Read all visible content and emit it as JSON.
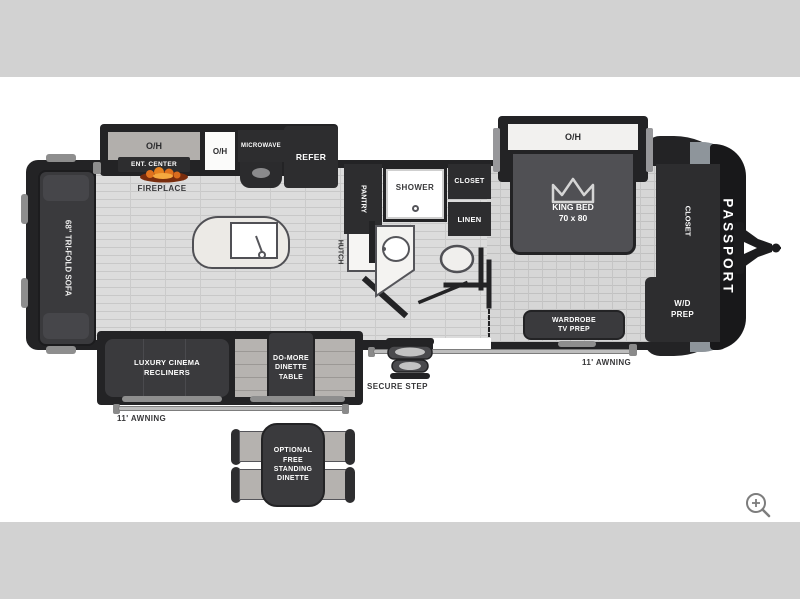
{
  "plan": {
    "kitchen": {
      "overhead_left": "O/H",
      "ent_center": "ENT. CENTER",
      "fireplace": "FIREPLACE",
      "overhead_mid": "O/H",
      "microwave": "MICROWAVE",
      "refrigerator": "REFER"
    },
    "living": {
      "sofa": "68\" TRI-FOLD SOFA",
      "pantry": "PANTRY",
      "hutch": "HUTCH",
      "recliners": "LUXURY CINEMA\nRECLINERS",
      "dinette_table": "DO-MORE\nDINETTE\nTABLE",
      "secure_step": "SECURE STEP",
      "awning": "11' AWNING"
    },
    "bathroom": {
      "shower": "SHOWER",
      "closet": "CLOSET",
      "linen": "LINEN"
    },
    "bedroom": {
      "overhead": "O/H",
      "king_bed": "KING BED\n70 x 80",
      "wardrobe": "WARDROBE\nTV PREP",
      "closet": "CLOSET",
      "wd_prep": "W/D\nPREP",
      "awning": "11' AWNING"
    },
    "exterior": {
      "brand": "PASSPORT"
    },
    "options": {
      "free_dinette": "OPTIONAL\nFREE\nSTANDING\nDINETTE"
    }
  },
  "viewer": {
    "zoom_button": "zoom-in"
  },
  "colors": {
    "letterbox_gray": "#d2d2d2",
    "wall_black": "#232325",
    "cabinet_dark": "#2d2d2f",
    "furniture_dark": "#3a3a3d",
    "bed_gray": "#505054",
    "floor_light": "#dcdcdc",
    "bench_gray": "#b6b3b0",
    "flame_orange": "#e0721e",
    "trim_silver": "#8e959b"
  }
}
